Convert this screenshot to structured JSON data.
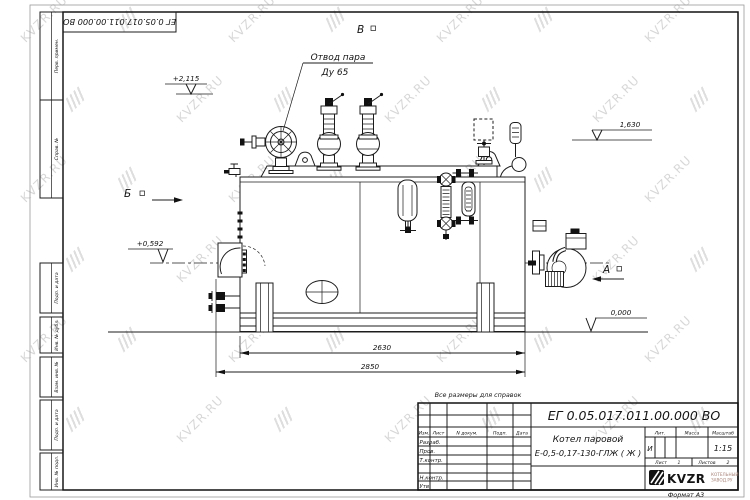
{
  "sheet": {
    "doc_number": "ЕГ 0.05.017.011.00.000  ВО",
    "format_label": "Формат А3",
    "reference_note": "Все размеры для справок",
    "watermark": {
      "text": "KVZR.RU"
    }
  },
  "margin_labels": [
    "Перв. примен.",
    "Справ. №",
    "Подп. и дата",
    "Инв. № дубл.",
    "Взам. инв. №",
    "Подп. и дата",
    "Инв. № подл."
  ],
  "title_block": {
    "header": {
      "izm": "Изм.",
      "list": "Лист",
      "ndokum": "N докум.",
      "podp": "Подп.",
      "data": "Дата"
    },
    "rows": {
      "razrab": "Разраб.",
      "prov": "Пров.",
      "tkontr": "Т.контр.",
      "nkontr": "Н.контр.",
      "utv": "Утв."
    },
    "name_line1": "Котел паровой",
    "name_line2": "Е-0,5-0,17-130-ГЛЖ ( Ж )",
    "lit_label": "Лит.",
    "mass_label": "Масса",
    "scale_label": "Масштаб",
    "lit_value": "И",
    "scale_value": "1:15",
    "sheet_label": "Лист",
    "sheet_value": "1",
    "sheets_label": "Листов",
    "sheets_value": "2",
    "company": {
      "logo_text": "KVZR",
      "tagline_line1": "КОТЕЛЬНЫЙ",
      "tagline_line2": "ЗАВОД.РУ"
    }
  },
  "annotations": {
    "steam_outlet_line1": "Отвод пара",
    "steam_outlet_line2": "Ду 65",
    "view_b_top": "В",
    "view_b_left": "Б",
    "view_a_right": "А",
    "elev_top": "+2,115",
    "elev_right": "1,630",
    "elev_left": "+0,592",
    "elev_zero": "0,000",
    "dim_inner": "2630",
    "dim_outer": "2850"
  }
}
